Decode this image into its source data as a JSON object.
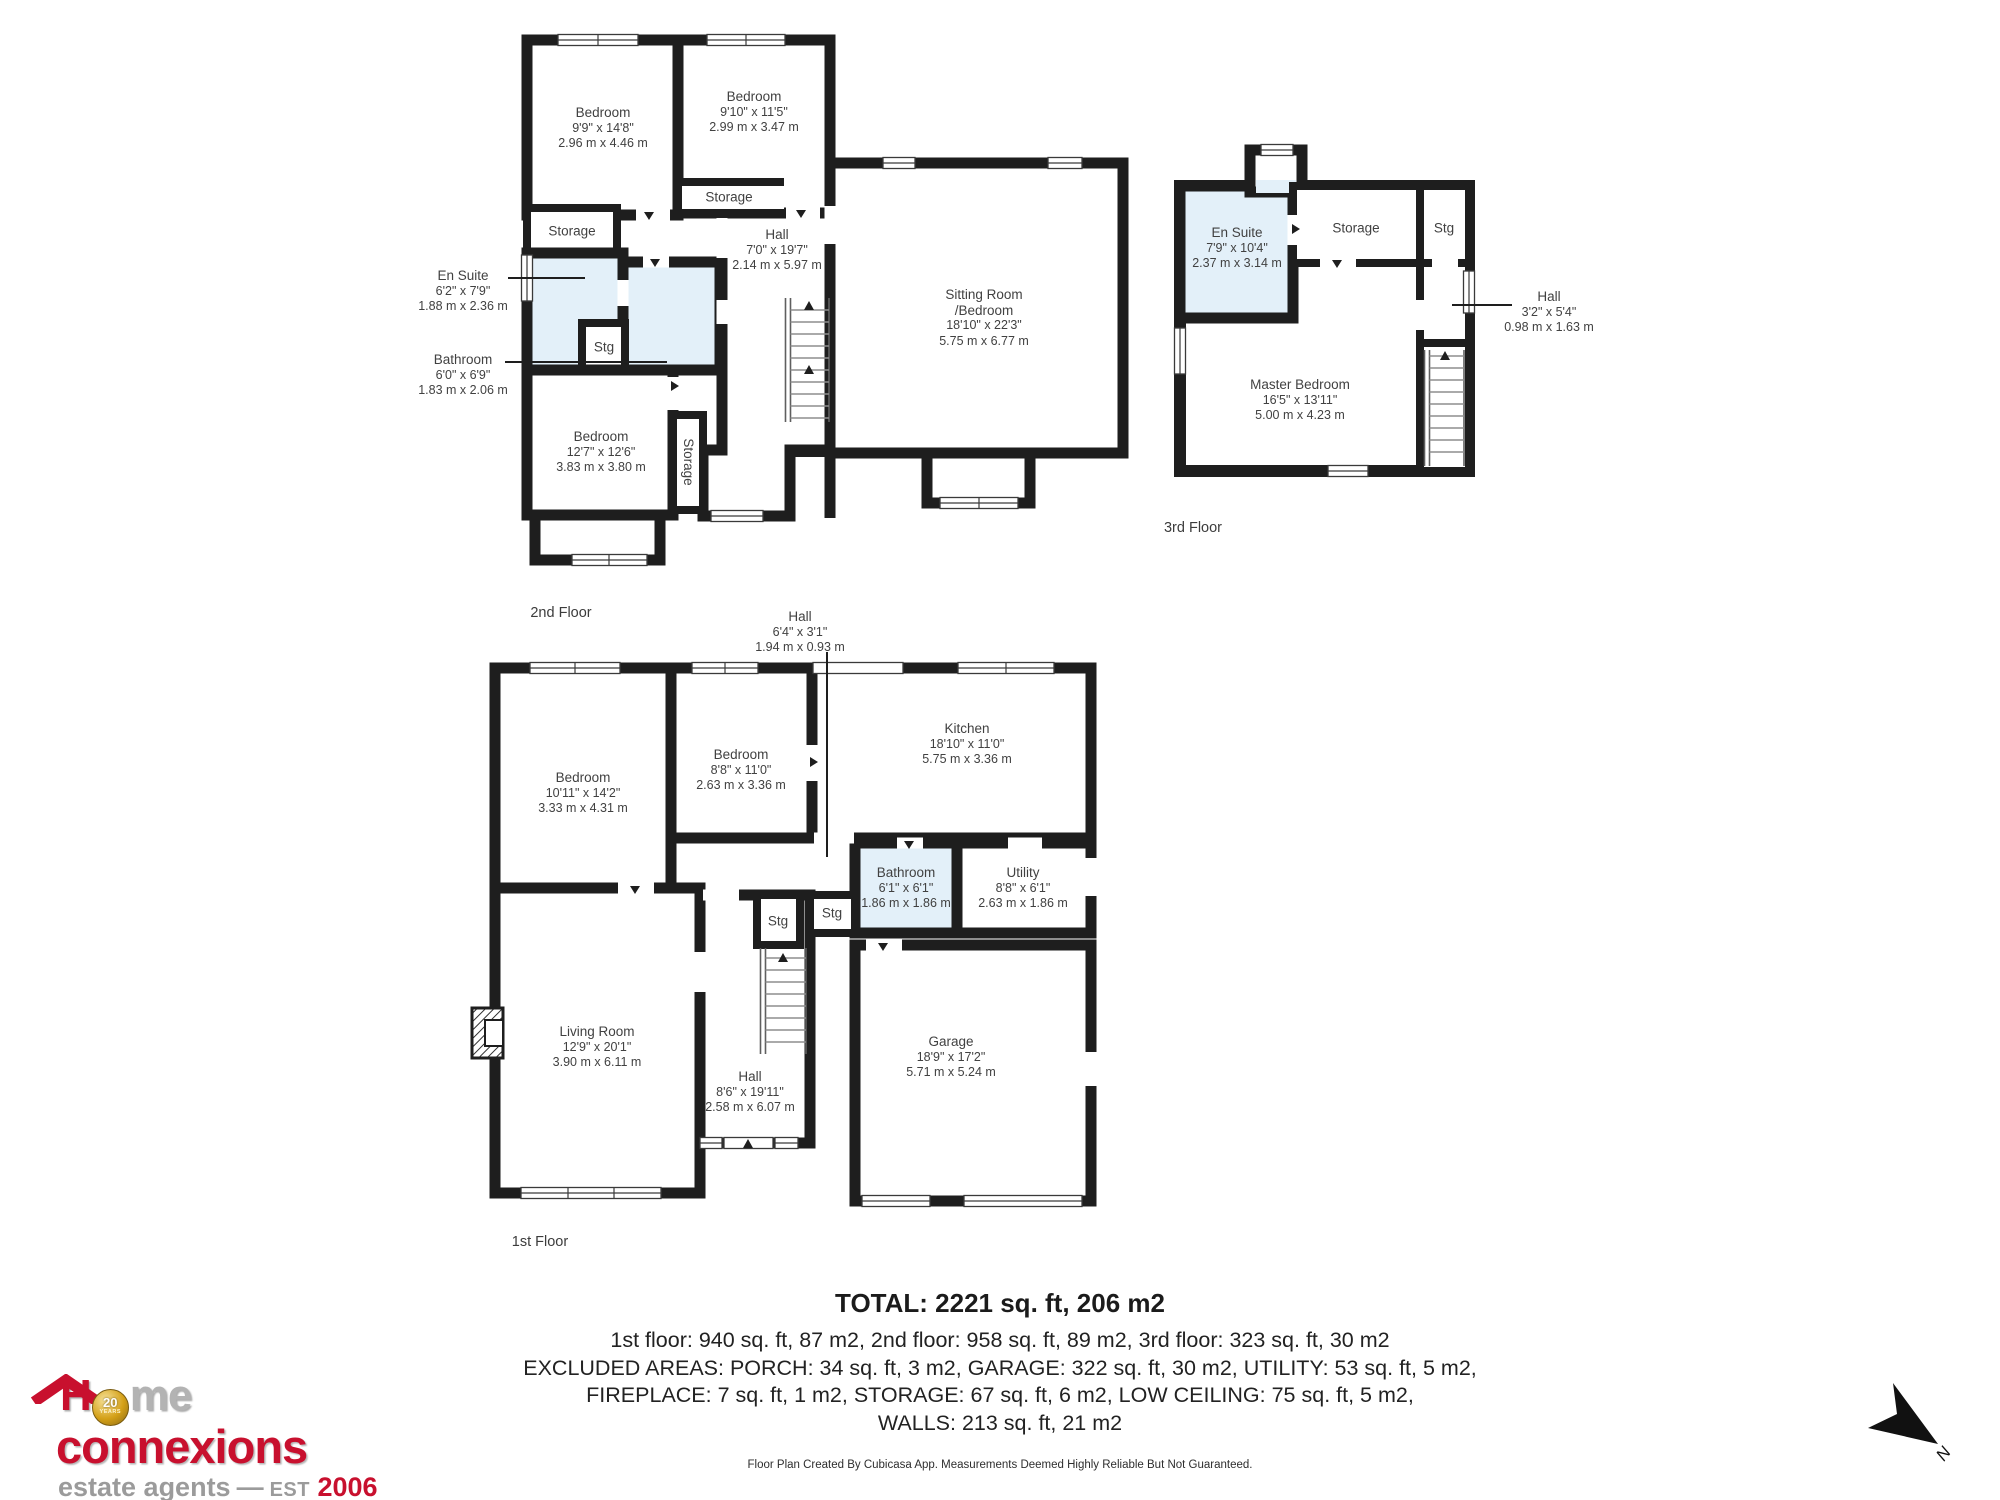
{
  "colors": {
    "wall_black": "#1e1e1e",
    "wet_room_blue": "#e3f0f9",
    "logo_red": "#c8102e",
    "logo_gray": "#9b9b9b",
    "coin_gold": "#d4a017"
  },
  "floors": {
    "floor2": {
      "label": "2nd Floor",
      "rooms": {
        "bedroom_top_left": {
          "name": "Bedroom",
          "imperial": "9'9\" x 14'8\"",
          "metric": "2.96 m x 4.46 m"
        },
        "bedroom_top_right": {
          "name": "Bedroom",
          "imperial": "9'10\" x 11'5\"",
          "metric": "2.99 m x 3.47 m"
        },
        "storage_top": {
          "name": "Storage"
        },
        "storage_left": {
          "name": "Storage"
        },
        "en_suite": {
          "name": "En Suite",
          "imperial": "6'2\" x 7'9\"",
          "metric": "1.88 m x 2.36 m"
        },
        "bathroom": {
          "name": "Bathroom",
          "imperial": "6'0\" x 6'9\"",
          "metric": "1.83 m x 2.06 m"
        },
        "stg": {
          "name": "Stg"
        },
        "hall": {
          "name": "Hall",
          "imperial": "7'0\" x 19'7\"",
          "metric": "2.14 m x 5.97 m"
        },
        "sitting_room": {
          "name": "Sitting Room",
          "name2": "/Bedroom",
          "imperial": "18'10\" x 22'3\"",
          "metric": "5.75 m x 6.77 m"
        },
        "bedroom_bottom": {
          "name": "Bedroom",
          "imperial": "12'7\" x 12'6\"",
          "metric": "3.83 m x 3.80 m"
        },
        "storage_stairs": {
          "name": "Storage"
        }
      }
    },
    "floor3": {
      "label": "3rd Floor",
      "rooms": {
        "en_suite": {
          "name": "En Suite",
          "imperial": "7'9\" x 10'4\"",
          "metric": "2.37 m x 3.14 m"
        },
        "storage": {
          "name": "Storage"
        },
        "stg": {
          "name": "Stg"
        },
        "hall": {
          "name": "Hall",
          "imperial": "3'2\" x 5'4\"",
          "metric": "0.98 m x 1.63 m"
        },
        "master_bedroom": {
          "name": "Master Bedroom",
          "imperial": "16'5\" x 13'11\"",
          "metric": "5.00 m x 4.23 m"
        }
      }
    },
    "floor1": {
      "label": "1st Floor",
      "rooms": {
        "hall_upper": {
          "name": "Hall",
          "imperial": "6'4\" x 3'1\"",
          "metric": "1.94 m x 0.93 m"
        },
        "bedroom_left": {
          "name": "Bedroom",
          "imperial": "10'11\" x 14'2\"",
          "metric": "3.33 m x 4.31 m"
        },
        "bedroom_mid": {
          "name": "Bedroom",
          "imperial": "8'8\" x 11'0\"",
          "metric": "2.63 m x 3.36 m"
        },
        "kitchen": {
          "name": "Kitchen",
          "imperial": "18'10\" x 11'0\"",
          "metric": "5.75 m x 3.36 m"
        },
        "bathroom": {
          "name": "Bathroom",
          "imperial": "6'1\" x 6'1\"",
          "metric": "1.86 m x 1.86 m"
        },
        "utility": {
          "name": "Utility",
          "imperial": "8'8\" x 6'1\"",
          "metric": "2.63 m x 1.86 m"
        },
        "stg_a": {
          "name": "Stg"
        },
        "stg_b": {
          "name": "Stg"
        },
        "living_room": {
          "name": "Living Room",
          "imperial": "12'9\" x 20'1\"",
          "metric": "3.90 m x 6.11 m"
        },
        "hall": {
          "name": "Hall",
          "imperial": "8'6\" x 19'11\"",
          "metric": "2.58 m x 6.07 m"
        },
        "garage": {
          "name": "Garage",
          "imperial": "18'9\" x 17'2\"",
          "metric": "5.71 m x 5.24 m"
        }
      }
    }
  },
  "summary": {
    "total": "TOTAL: 2221 sq. ft, 206 m2",
    "line1": "1st floor: 940 sq. ft, 87 m2, 2nd floor: 958 sq. ft, 89 m2, 3rd floor: 323 sq. ft, 30 m2",
    "line2": "EXCLUDED AREAS: PORCH: 34 sq. ft, 3 m2, GARAGE: 322 sq. ft, 30 m2, UTILITY: 53 sq. ft, 5 m2,",
    "line3": "FIREPLACE: 7 sq. ft, 1 m2, STORAGE: 67 sq. ft, 6 m2, LOW CEILING: 75 sq. ft, 5 m2,",
    "line4": "WALLS: 213 sq. ft, 21 m2",
    "credit": "Floor Plan Created By Cubicasa App. Measurements Deemed Highly Reliable But Not Guaranteed."
  },
  "logo": {
    "letter_h": "H",
    "coin_top": "20",
    "coin_bottom": "YEARS",
    "word_me": "me",
    "word2": "connexions",
    "tagline": "estate agents",
    "dash": "—",
    "est": "EST",
    "year": "2006"
  },
  "compass": {
    "north_label": "N"
  }
}
